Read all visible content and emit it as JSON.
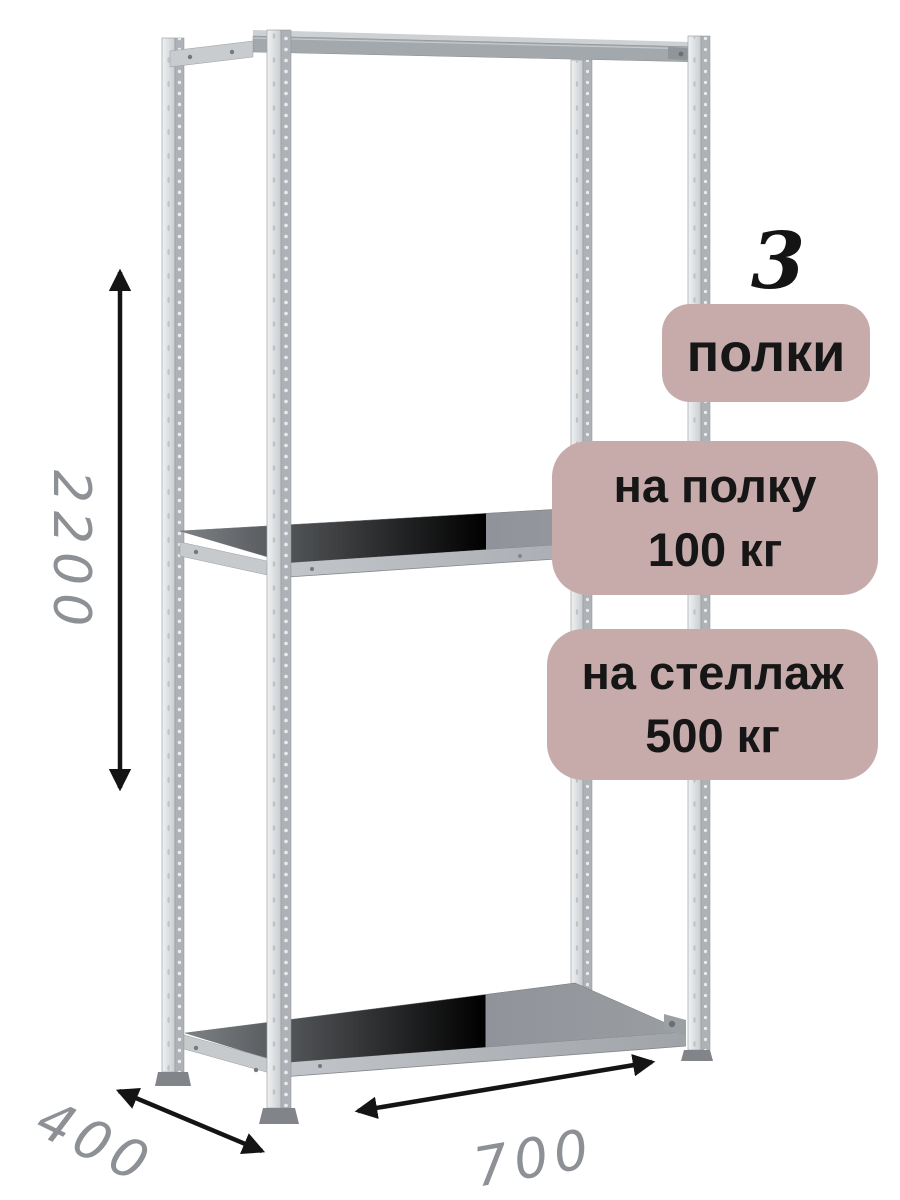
{
  "product_view": {
    "type": "metal-shelving-rack-product-image",
    "shelf_count_on_image": 3
  },
  "badges": {
    "count_number": "3",
    "count_label": "полки",
    "per_shelf": {
      "line1": "на полку",
      "line2": "100 кг"
    },
    "per_rack": {
      "line1": "на стеллаж",
      "line2": "500 кг"
    },
    "bg_color": "#c7abab",
    "text_color": "#161616"
  },
  "dimensions": {
    "height": "2200",
    "depth": "400",
    "width": "700",
    "label_color": "#8d9195",
    "arrow_color": "#141414"
  },
  "illustration_colors": {
    "metal_light": "#e9ebed",
    "metal_mid": "#aeb2b6",
    "shelf_top": "#84888c",
    "shelf_edge": "#c2c6ca"
  }
}
